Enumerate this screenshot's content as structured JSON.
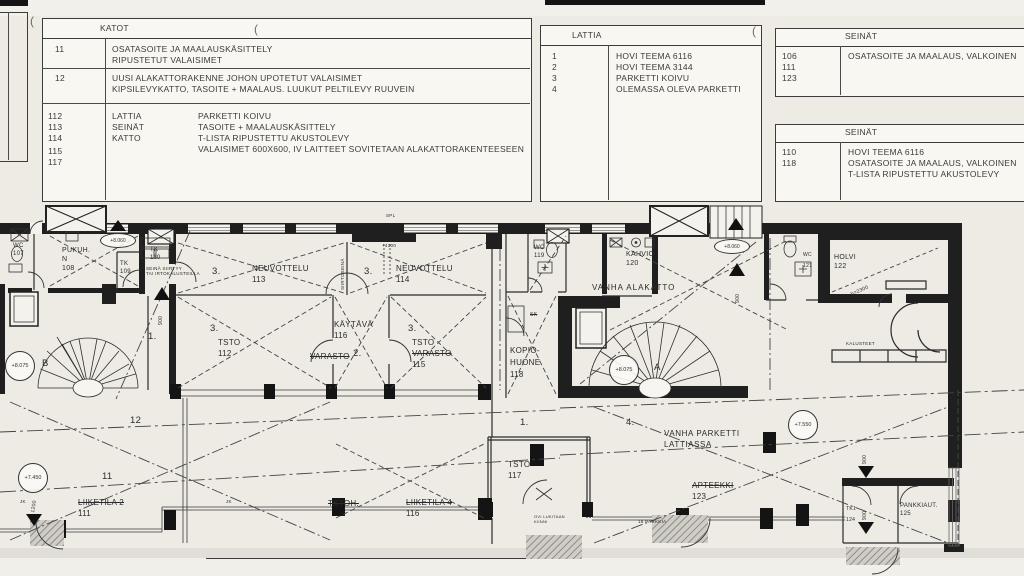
{
  "legend": {
    "katot": {
      "title": "KATOT",
      "row11_code": "11",
      "row11_l1": "OSATASOITE JA MAALAUSKÄSITTELY",
      "row11_l2": "RIPUSTETUT VALAISIMET",
      "row12_code": "12",
      "row12_l1": "UUSI ALAKATTORAKENNE JOHON UPOTETUT VALAISIMET",
      "row12_l2": "KIPSILEVYKATTO, TASOITE + MAALAUS. LUUKUT PELTILEVY RUUVEIN",
      "grp_codes": [
        "112",
        "113",
        "114",
        "115",
        "117"
      ],
      "grp_labels": [
        "LATTIA",
        "SEINÄT",
        "KATTO"
      ],
      "grp_descs": [
        "PARKETTI KOIVU",
        "TASOITE + MAALAUSKÄSITTELY",
        "T-LISTA RIPUSTETTU AKUSTOLEVY",
        "VALAISIMET 600X600, IV LAITTEET SOVITETAAN ALAKATTORAKENTEESEEN"
      ]
    },
    "lattia": {
      "title": "LATTIA",
      "codes": [
        "1",
        "2",
        "3",
        "4"
      ],
      "descs": [
        "HOVI TEEMA 6116",
        "HOVI TEEMA 3144",
        "PARKETTI KOIVU",
        "OLEMASSA OLEVA PARKETTI"
      ]
    },
    "seinat1": {
      "title": "SEINÄT",
      "codes": [
        "106",
        "111",
        "123"
      ],
      "descs": [
        "OSATASOITE JA MAALAUS, VALKOINEN"
      ]
    },
    "seinat2": {
      "title": "SEINÄT",
      "codes": [
        "110",
        "118"
      ],
      "descs": [
        "HOVI TEEMA 6116",
        "OSATASOITE JA MAALAUS, VALKOINEN",
        "T-LISTA RIPUSTETTU AKUSTOLEVY"
      ]
    }
  },
  "plan": {
    "rooms": {
      "wc107": [
        "WC",
        "107"
      ],
      "pukuh108": [
        "PUKUH.",
        "N",
        "108"
      ],
      "tk109": [
        "TK",
        "109"
      ],
      "tk110": [
        "TK",
        "110"
      ],
      "neuvottelu113": [
        "NEUVOTTELU",
        "113"
      ],
      "neuvottelu114": [
        "NEUVOTTELU",
        "114"
      ],
      "tsto112": [
        "TSTO",
        "112"
      ],
      "kaytava116": [
        "KÄYTÄVÄ",
        "116"
      ],
      "varasto": "VARASTO",
      "tsto115": [
        "TSTO",
        "VARASTO",
        "115"
      ],
      "wc119": [
        "WC",
        "119"
      ],
      "kahvio120": [
        "KAHVIO",
        "120"
      ],
      "kopiohuone118": [
        "KOPIO-",
        "HUONE",
        "118"
      ],
      "wc121": [
        "WC",
        "121"
      ],
      "holvi122": [
        "HOLVI",
        "122"
      ],
      "liiketila2": [
        "LIIKETILA 2",
        "111"
      ],
      "tstoh": "TSTOH.",
      "liiketila4": [
        "LIIKETILA 4",
        "116"
      ],
      "tsto117": [
        "TSTO",
        "117"
      ],
      "apteekki123": [
        "APTEEKKI",
        "123"
      ],
      "tk1": [
        "TK1",
        "124"
      ],
      "pankkiaut": [
        "PANKKIAUT.",
        "125"
      ]
    },
    "annotations": {
      "vanha_alakatto": "VANHA ALAKATTO",
      "vanha_parketti_1": "VANHA PARKETTI",
      "vanha_parketti_2": "LATTIASSA",
      "siirtoseina": "SIIRTOSEINÄ",
      "seina_siirtyy_1": "SEINÄ SIIRTYY",
      "seina_siirtyy_2": "TAI IRTOKALUSTEILLA",
      "ovi_lukitaan_1": "OVI LUKITAAN",
      "ovi_lukitaan_2": "KIINNI",
      "parkkia": "18 PARKKIA",
      "spl": "SPL",
      "plus4300": "+4300",
      "h2300": "h=2300",
      "kalusteet": "KALUSTEET",
      "sk": "SK",
      "jk": "JK",
      "stair_a": "A",
      "stair_b": "B",
      "artifact": "("
    },
    "levels": {
      "l8075": "+8.075",
      "l8060": "+8.060",
      "l7450": "+7.450",
      "l7550": "+7.550"
    },
    "dims": {
      "d900": "900",
      "d1200": "1200"
    },
    "nums": {
      "n1": "1.",
      "n2": "2.",
      "n3": "3.",
      "n4": "4.",
      "n11": "11",
      "n12": "12"
    }
  }
}
